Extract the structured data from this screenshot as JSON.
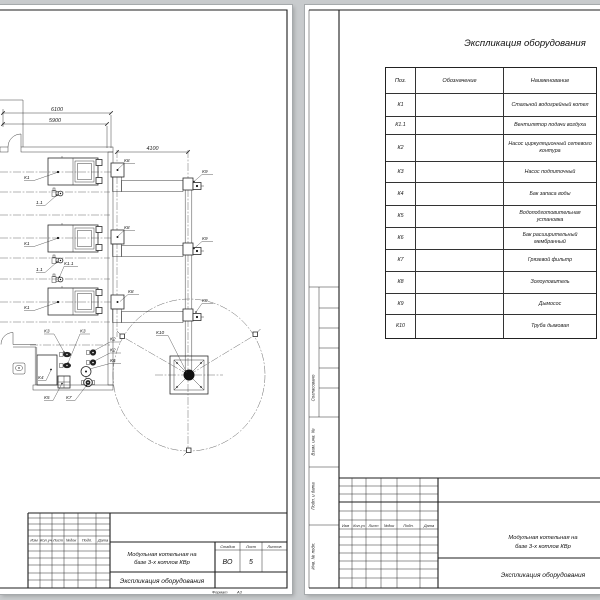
{
  "colors": {
    "background": "#c8cbcd",
    "page": "#ffffff",
    "line": "#2b2b2b"
  },
  "drawing": {
    "dim_6100": "6100",
    "dim_5900": "5900",
    "dim_4100": "4100",
    "labels": {
      "k1": "К1",
      "k1_1": "К1.1",
      "f11": "1.1",
      "k2": "К2",
      "k3": "К3",
      "k4": "К4",
      "k5": "К5",
      "k6": "К6",
      "k7": "К7",
      "k8": "К8",
      "k9": "К9",
      "k10": "К10"
    }
  },
  "stamp_columns": [
    "Изм",
    "Кол.уч",
    "Лист",
    "№док",
    "Подп.",
    "Дата"
  ],
  "left_stamp": {
    "project_line1": "Модульная котельная на",
    "project_line2": "базе 3-х котлов КВр",
    "doc_title": "Экспликация оборудования",
    "stage_label": "Стадия",
    "stage_value": "ВО",
    "sheet_label": "Лист",
    "sheet_value": "5",
    "sheets_label": "Листов",
    "format_label": "Формат",
    "format_value": "А3"
  },
  "right_page": {
    "title": "Экспликация оборудования",
    "table": {
      "col_pos": "Поз.",
      "col_designation": "Обозначение",
      "col_name": "Наименование",
      "rows": [
        {
          "pos": "К1",
          "name": "Стальной водогрейный котел"
        },
        {
          "pos": "К1.1",
          "name": "Вентилятор подачи воздуха"
        },
        {
          "pos": "К2",
          "name": "Насос циркуляционный сетевого контура"
        },
        {
          "pos": "К3",
          "name": "Насос подпиточный"
        },
        {
          "pos": "К4",
          "name": "Бак запаса воды"
        },
        {
          "pos": "К5",
          "name": "Водоподготовительная установка"
        },
        {
          "pos": "К6",
          "name": "Бак расширительный мембранный"
        },
        {
          "pos": "К7",
          "name": "Грязевой фильтр"
        },
        {
          "pos": "К8",
          "name": "Золоуловитель"
        },
        {
          "pos": "К9",
          "name": "Дымосос"
        },
        {
          "pos": "К10",
          "name": "Труба дымовая"
        }
      ]
    },
    "margin_labels": {
      "approved": "Согласовано",
      "replace_inv": "Взам. инв. №",
      "sign_date": "Подп. и дата",
      "inv_orig": "Инв. № подл."
    },
    "stamp": {
      "project_line1": "Модульная котельная на",
      "project_line2": "базе 3-х котлов КВр",
      "doc_title": "Экспликация оборудования"
    }
  }
}
